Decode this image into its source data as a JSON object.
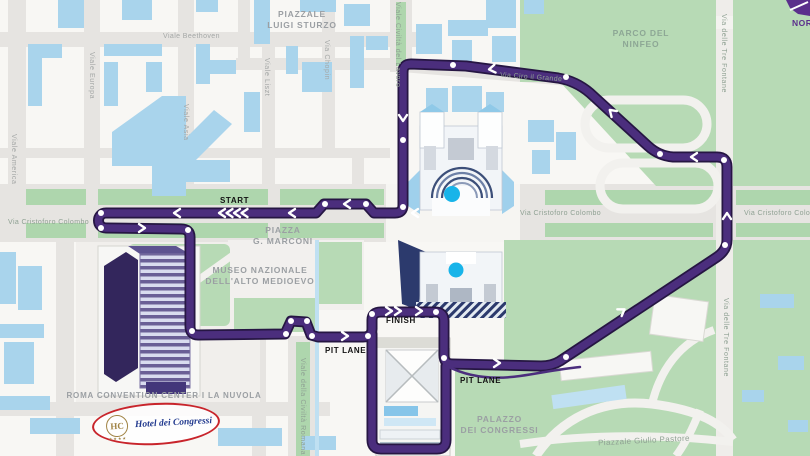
{
  "title": "Rome EUR street circuit map",
  "colors": {
    "track_purple": "#4b2e7d",
    "track_outline": "#261643",
    "building_blue": "#a9d4ec",
    "park_green": "#b7dab5",
    "street_gray": "#e6e4e1",
    "label_gray": "#a4a7a6",
    "fountain_cyan": "#18b4e9",
    "logo_red": "#c8242b",
    "logo_blue": "#223a8f",
    "logo_gold": "#a08344",
    "compass_purple": "#5b2f8c"
  },
  "streets": {
    "viale_beethoven": "Viale Beethoven",
    "viale_europa": "Viale Europa",
    "viale_asia": "Viale Asia",
    "viale_america": "Viale America",
    "viale_liszt": "Viale Liszt",
    "via_chopin": "Via Chopin",
    "viale_civilta_del_lavoro": "Viale Civiltà del Lavoro",
    "via_ciro_il_grande": "Via Ciro il Grande",
    "via_delle_tre_fontane_top": "Via delle Tre Fontane",
    "via_delle_tre_fontane_bottom": "Via delle Tre Fontane",
    "via_cristoforo_colombo_left": "Via Cristoforo Colombo",
    "via_cristoforo_colombo_center": "Via Cristoforo Colombo",
    "via_cristoforo_colombo_right": "Via Cristoforo Colombo",
    "viale_della_civilta_romana": "Viale della Civiltà Romana",
    "piazzale_giulio_pastore": "Piazzale Giulio Pastore"
  },
  "places": {
    "piazzale_luigi_sturzo": "PIAZZALE\nLUIGI STURZO",
    "parco_del_ninfeo": "PARCO DEL\nNINFEO",
    "piazza_marconi": "PIAZZA\nG. MARCONI",
    "museo_nazionale": "MUSEO NAZIONALE\nDELL'ALTO MEDIOEVO",
    "palazzo_dei_congressi": "PALAZZO\nDEI CONGRESSI",
    "roma_convention_center": "ROMA CONVENTION CENTER I LA NUVOLA"
  },
  "track_labels": {
    "start": "START",
    "finish": "FINISH",
    "pit_lane_left": "PIT LANE",
    "pit_lane_right": "PIT LANE"
  },
  "logo": {
    "monogram": "HC",
    "name": "Hotel dei Congressi",
    "stars": "★★★★"
  },
  "compass": {
    "text": "NOR"
  }
}
